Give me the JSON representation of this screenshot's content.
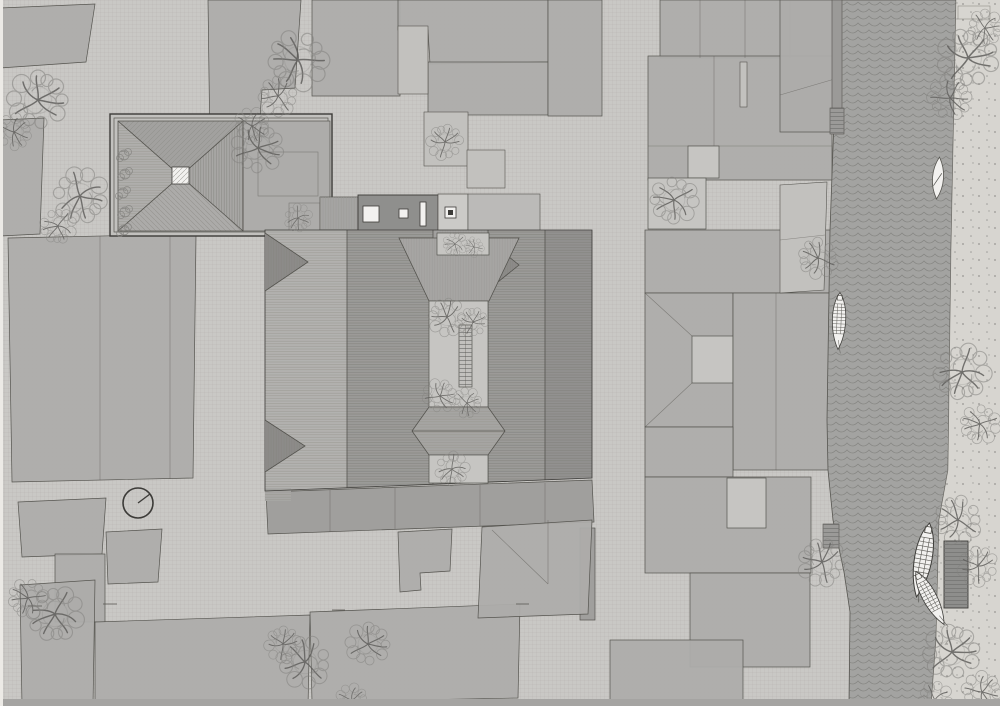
{
  "document": {
    "kind": "architectural site plan (roof plan), top-down technical drawing",
    "visible_text": "none",
    "canvas": {
      "width": 1000,
      "height": 706
    }
  },
  "palette": {
    "base": "#c9c8c5",
    "paperLine": "#8f8d88",
    "parcel": "#adacaa",
    "parcelDark": "#a09f9d",
    "parcelLight": "#c2c1be",
    "courtyard": "#c6c5c2",
    "white": "#f2f1ef",
    "roofLightFill": "#b3b2b0",
    "roofDarkFill": "#9c9b99",
    "roofDarkerFill": "#929190",
    "hipTriangle": "#8c8b89",
    "flatRoofDark": "#8f8f8d",
    "river": "#a3a3a1",
    "wave": "#6e6e6c",
    "bank": "#d7d5d0",
    "stipple": "#62625f",
    "dock": "#8e8e8c",
    "treeStroke": "#83827f",
    "branch": "#5f5e5c",
    "outline": "#55544f",
    "outlineStrong": "#3c3b38",
    "bottomBand": "#a5a4a2",
    "quay": "#9b9a98"
  },
  "plan_elements": {
    "north_indicator": {
      "cx": 138,
      "cy": 503,
      "r": 15,
      "needle_dx": 12,
      "needle_dy": -9
    },
    "trees": [
      [
        38,
        100,
        1.5
      ],
      [
        14,
        132,
        0.9
      ],
      [
        80,
        196,
        1.4
      ],
      [
        58,
        226,
        0.9
      ],
      [
        298,
        60,
        1.5
      ],
      [
        278,
        96,
        1.0
      ],
      [
        445,
        142,
        0.9
      ],
      [
        258,
        148,
        1.3
      ],
      [
        252,
        126,
        0.9
      ],
      [
        298,
        218,
        0.7
      ],
      [
        455,
        244,
        0.6
      ],
      [
        474,
        247,
        0.5
      ],
      [
        447,
        317,
        0.95
      ],
      [
        473,
        322,
        0.75
      ],
      [
        440,
        396,
        0.85
      ],
      [
        467,
        403,
        0.75
      ],
      [
        452,
        469,
        0.85
      ],
      [
        674,
        200,
        1.2
      ],
      [
        818,
        258,
        1.0
      ],
      [
        822,
        562,
        1.2
      ],
      [
        968,
        58,
        1.5
      ],
      [
        950,
        98,
        1.1
      ],
      [
        985,
        28,
        0.9
      ],
      [
        962,
        372,
        1.4
      ],
      [
        980,
        424,
        1.0
      ],
      [
        958,
        520,
        1.2
      ],
      [
        978,
        566,
        1.0
      ],
      [
        952,
        652,
        1.4
      ],
      [
        982,
        692,
        1.0
      ],
      [
        935,
        700,
        0.9
      ],
      [
        55,
        614,
        1.4
      ],
      [
        28,
        598,
        1.0
      ],
      [
        305,
        662,
        1.3
      ],
      [
        283,
        644,
        0.9
      ],
      [
        368,
        644,
        1.1
      ],
      [
        352,
        700,
        0.8
      ]
    ],
    "bushes": [
      [
        124,
        155
      ],
      [
        125,
        174
      ],
      [
        123,
        193
      ],
      [
        125,
        212
      ],
      [
        124,
        230
      ]
    ],
    "boats": [
      {
        "kind": "skiff",
        "x": 938,
        "y": 178,
        "rot": 4,
        "s": 1.0
      },
      {
        "kind": "covered",
        "x": 839,
        "y": 321,
        "rot": 2,
        "s": 0.95
      },
      {
        "kind": "covered",
        "x": 923,
        "y": 560,
        "rot": 10,
        "s": 1.25
      },
      {
        "kind": "covered",
        "x": 930,
        "y": 598,
        "rot": -28,
        "s": 1.0
      }
    ],
    "skylights": [
      {
        "x": 363,
        "y": 206,
        "w": 16,
        "h": 16
      },
      {
        "x": 399,
        "y": 209,
        "w": 9,
        "h": 9
      },
      {
        "x": 420,
        "y": 202,
        "w": 6,
        "h": 24
      },
      {
        "x": 445,
        "y": 207,
        "w": 11,
        "h": 11,
        "inner": true
      }
    ],
    "roof_lantern": {
      "x": 172,
      "y": 167,
      "size": 17
    }
  },
  "icons": [
    "north-indicator",
    "tree-icon",
    "bush-icon",
    "boat-icon",
    "wave-pattern",
    "stipple-pattern",
    "roof-hatch"
  ]
}
